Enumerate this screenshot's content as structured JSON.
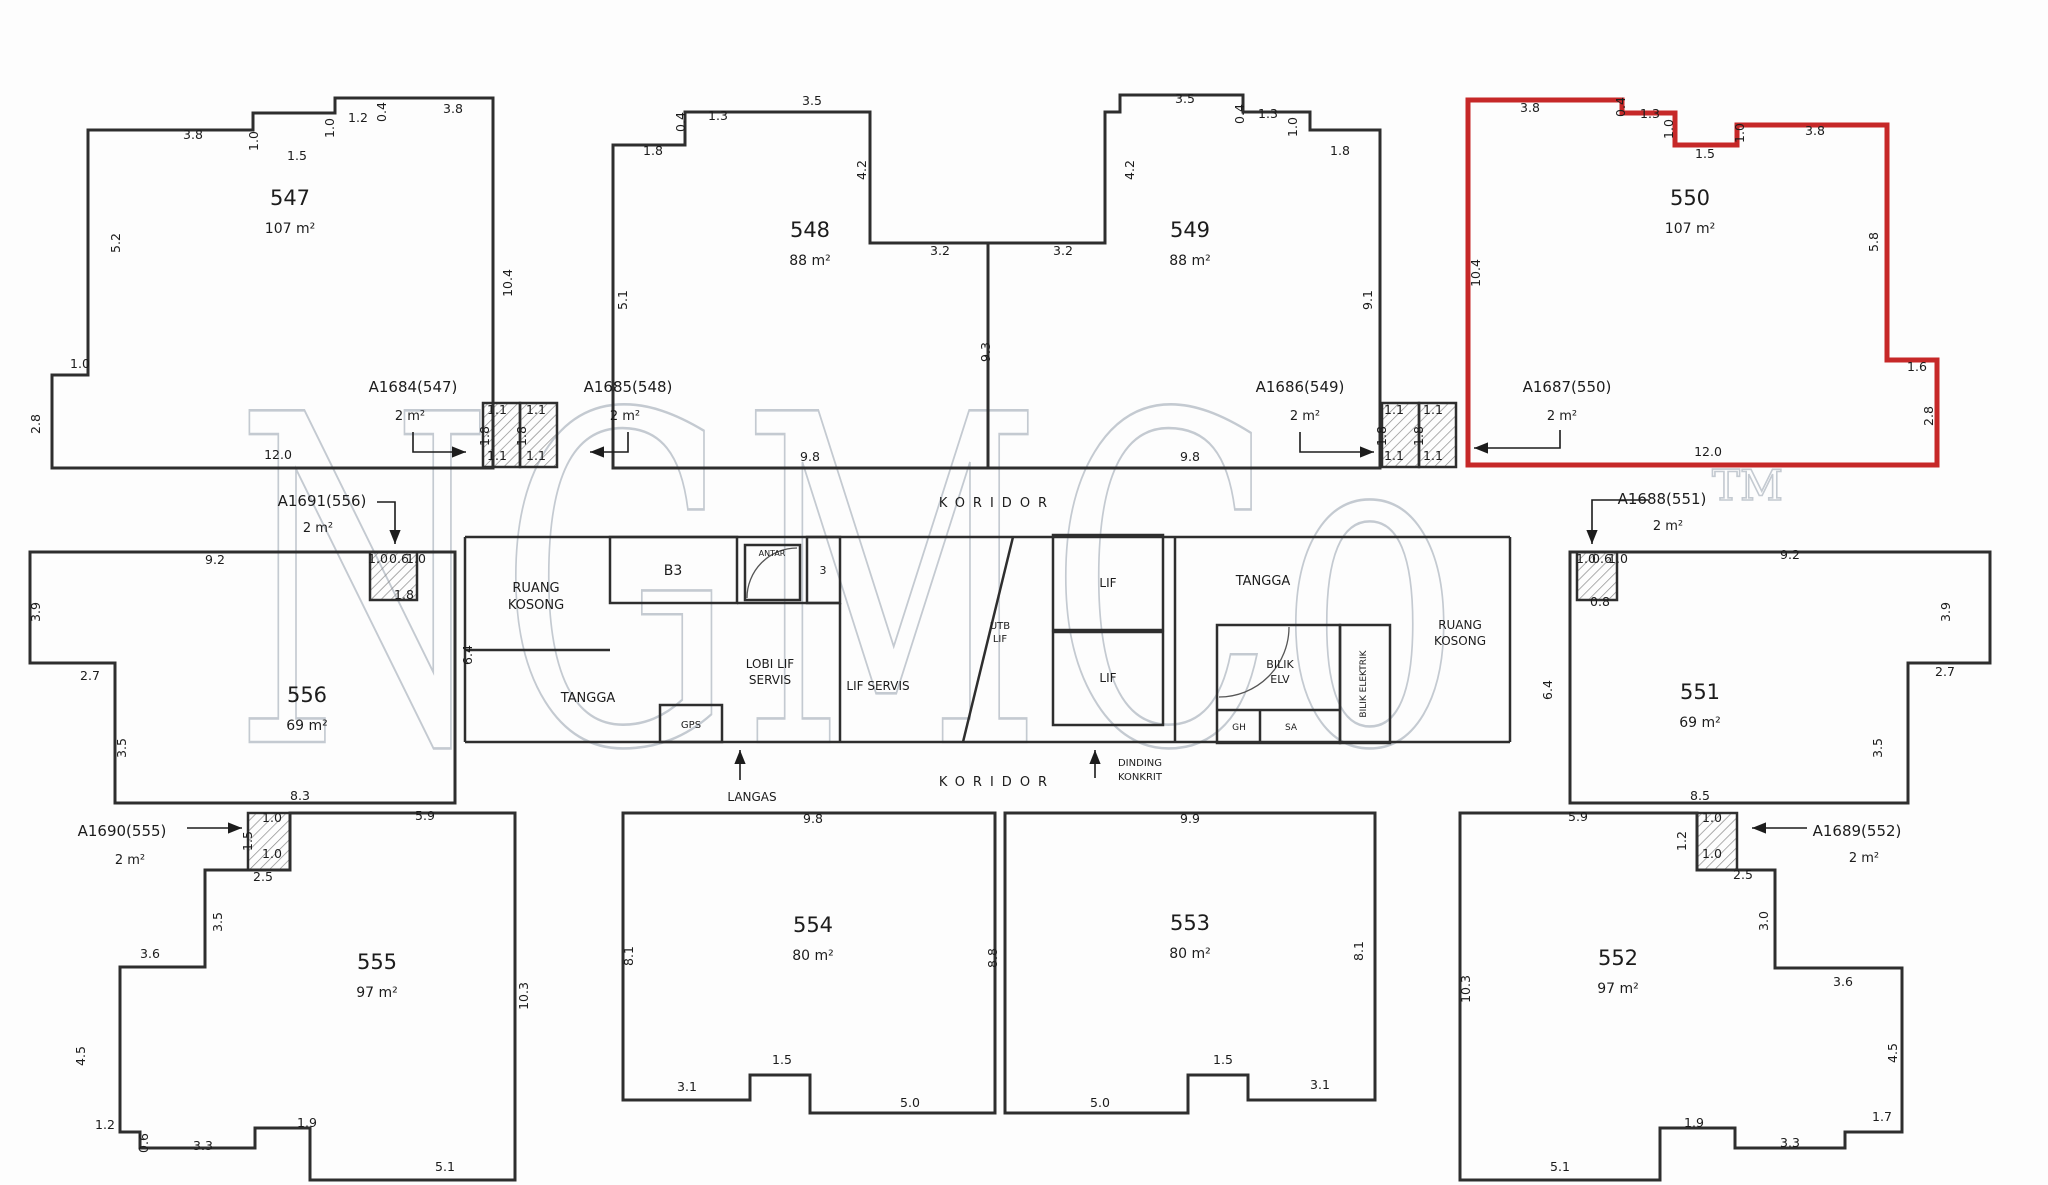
{
  "meta": {
    "background": "#fdfdfd",
    "wall_color": "#2e2e2e",
    "thin_color": "#555555",
    "highlight_color": "#c62828",
    "dim_color": "#1c1c1c",
    "watermark": {
      "text": "NGMCo",
      "tm": "TM",
      "color": "#c4cad1",
      "x": 235,
      "y": 742,
      "size": 455,
      "span": 1230,
      "tm_x": 1712,
      "tm_y": 500,
      "tm_size": 42
    }
  },
  "units": [
    {
      "id": "547",
      "number": "547",
      "area": "107 m²",
      "highlighted": false,
      "points": "88,130 253,130 253,113 335,113 335,98 493,98 493,468 52,468 52,375 88,375",
      "nx": 290,
      "ny": 205,
      "ax": 290,
      "ay": 233
    },
    {
      "id": "548",
      "number": "548",
      "area": "88 m²",
      "highlighted": false,
      "points": "613,145 685,145 685,112 870,112 870,243 988,243 988,468 613,468",
      "nx": 810,
      "ny": 237,
      "ax": 810,
      "ay": 265
    },
    {
      "id": "549",
      "number": "549",
      "area": "88 m²",
      "highlighted": false,
      "points": "1120,95 1243,95 1243,112 1310,112 1310,130 1380,130 1380,468 988,468 988,243 1105,243 1105,112 1120,112",
      "nx": 1190,
      "ny": 237,
      "ax": 1190,
      "ay": 265
    },
    {
      "id": "550",
      "number": "550",
      "area": "107 m²",
      "highlighted": true,
      "points": "1468,100 1622,100 1622,113 1675,113 1675,145 1737,145 1737,125 1887,125 1887,360 1937,360 1937,465 1468,465",
      "nx": 1690,
      "ny": 205,
      "ax": 1690,
      "ay": 233
    },
    {
      "id": "556",
      "number": "556",
      "area": "69 m²",
      "highlighted": false,
      "points": "30,552 455,552 455,803 115,803 115,663 30,663",
      "nx": 307,
      "ny": 702,
      "ax": 307,
      "ay": 730
    },
    {
      "id": "551",
      "number": "551",
      "area": "69 m²",
      "highlighted": false,
      "points": "1570,552 1990,552 1990,663 1908,663 1908,803 1570,803",
      "nx": 1700,
      "ny": 699,
      "ax": 1700,
      "ay": 727
    },
    {
      "id": "555",
      "number": "555",
      "area": "97 m²",
      "highlighted": false,
      "points": "515,813 290,813 290,870 205,870 205,967 120,967 120,1132 140,1132 140,1148 255,1148 255,1128 310,1128 310,1180 515,1180",
      "nx": 377,
      "ny": 969,
      "ax": 377,
      "ay": 997
    },
    {
      "id": "554",
      "number": "554",
      "area": "80 m²",
      "highlighted": false,
      "points": "623,813 995,813 995,1113 810,1113 810,1075 750,1075 750,1100 623,1100",
      "nx": 813,
      "ny": 932,
      "ax": 813,
      "ay": 960
    },
    {
      "id": "553",
      "number": "553",
      "area": "80 m²",
      "highlighted": false,
      "points": "1005,813 1375,813 1375,1100 1248,1100 1248,1075 1188,1075 1188,1113 1005,1113",
      "nx": 1190,
      "ny": 930,
      "ax": 1190,
      "ay": 958
    },
    {
      "id": "552",
      "number": "552",
      "area": "97 m²",
      "highlighted": false,
      "points": "1460,813 1697,813 1697,870 1775,870 1775,968 1902,968 1902,1132 1845,1132 1845,1148 1735,1148 1735,1128 1660,1128 1660,1180 1460,1180",
      "nx": 1618,
      "ny": 965,
      "ax": 1618,
      "ay": 993
    }
  ],
  "ref_labels": [
    {
      "id": "A1684",
      "text": "A1684(547)",
      "sub": "2 m²",
      "x": 413,
      "y": 392,
      "sx": 410,
      "sy": 420,
      "arrow": [
        [
          413,
          432
        ],
        [
          413,
          452
        ],
        [
          466,
          452
        ]
      ],
      "dir": "right"
    },
    {
      "id": "A1685",
      "text": "A1685(548)",
      "sub": "2 m²",
      "x": 628,
      "y": 392,
      "sx": 625,
      "sy": 420,
      "arrow": [
        [
          628,
          432
        ],
        [
          628,
          452
        ],
        [
          590,
          452
        ]
      ],
      "dir": "left"
    },
    {
      "id": "A1686",
      "text": "A1686(549)",
      "sub": "2 m²",
      "x": 1300,
      "y": 392,
      "sx": 1305,
      "sy": 420,
      "arrow": [
        [
          1300,
          432
        ],
        [
          1300,
          452
        ],
        [
          1374,
          452
        ]
      ],
      "dir": "right"
    },
    {
      "id": "A1687",
      "text": "A1687(550)",
      "sub": "2 m²",
      "x": 1567,
      "y": 392,
      "sx": 1562,
      "sy": 420,
      "arrow": [
        [
          1560,
          430
        ],
        [
          1560,
          448
        ],
        [
          1474,
          448
        ]
      ],
      "dir": "left"
    },
    {
      "id": "A1691",
      "text": "A1691(556)",
      "sub": "2 m²",
      "x": 322,
      "y": 506,
      "sx": 318,
      "sy": 532,
      "arrow": [
        [
          377,
          502
        ],
        [
          395,
          502
        ],
        [
          395,
          544
        ]
      ],
      "dir": "down"
    },
    {
      "id": "A1690",
      "text": "A1690(555)",
      "sub": "2 m²",
      "x": 122,
      "y": 836,
      "sx": 130,
      "sy": 864,
      "arrow": [
        [
          187,
          828
        ],
        [
          242,
          828
        ]
      ],
      "dir": "right"
    },
    {
      "id": "A1688",
      "text": "A1688(551)",
      "sub": "2 m²",
      "x": 1662,
      "y": 504,
      "sx": 1668,
      "sy": 530,
      "arrow": [
        [
          1648,
          500
        ],
        [
          1592,
          500
        ],
        [
          1592,
          544
        ]
      ],
      "dir": "down"
    },
    {
      "id": "A1689",
      "text": "A1689(552)",
      "sub": "2 m²",
      "x": 1857,
      "y": 836,
      "sx": 1864,
      "sy": 862,
      "arrow": [
        [
          1807,
          828
        ],
        [
          1752,
          828
        ]
      ],
      "dir": "left"
    }
  ],
  "core_labels": [
    {
      "t": "RUANG",
      "x": 536,
      "y": 592,
      "s": 13
    },
    {
      "t": "KOSONG",
      "x": 536,
      "y": 609,
      "s": 13
    },
    {
      "t": "TANGGA",
      "x": 588,
      "y": 702,
      "s": 13
    },
    {
      "t": "B3",
      "x": 673,
      "y": 575,
      "s": 14
    },
    {
      "t": "ANTAR",
      "x": 772,
      "y": 556,
      "s": 8
    },
    {
      "t": "3",
      "x": 823,
      "y": 574,
      "s": 11
    },
    {
      "t": "LOBI LIF",
      "x": 770,
      "y": 668,
      "s": 12
    },
    {
      "t": "SERVIS",
      "x": 770,
      "y": 684,
      "s": 12
    },
    {
      "t": "LIF SERVIS",
      "x": 878,
      "y": 690,
      "s": 12
    },
    {
      "t": "GPS",
      "x": 691,
      "y": 728,
      "s": 10
    },
    {
      "t": "LANGAS",
      "x": 752,
      "y": 801,
      "s": 12
    },
    {
      "t": "LIF",
      "x": 1108,
      "y": 587,
      "s": 12
    },
    {
      "t": "LIF",
      "x": 1108,
      "y": 682,
      "s": 12
    },
    {
      "t": "UTB",
      "x": 1000,
      "y": 629,
      "s": 10
    },
    {
      "t": "LIF",
      "x": 1000,
      "y": 642,
      "s": 10
    },
    {
      "t": "TANGGA",
      "x": 1263,
      "y": 585,
      "s": 13
    },
    {
      "t": "BILIK",
      "x": 1280,
      "y": 668,
      "s": 11
    },
    {
      "t": "ELV",
      "x": 1280,
      "y": 683,
      "s": 11
    },
    {
      "t": "GH",
      "x": 1239,
      "y": 730,
      "s": 9
    },
    {
      "t": "SA",
      "x": 1291,
      "y": 730,
      "s": 9
    },
    {
      "t": "BILIK ELEKTRIK",
      "x": 1366,
      "y": 684,
      "s": 9,
      "r": 1
    },
    {
      "t": "RUANG",
      "x": 1460,
      "y": 629,
      "s": 12
    },
    {
      "t": "KOSONG",
      "x": 1460,
      "y": 645,
      "s": 12
    },
    {
      "t": "DINDING",
      "x": 1140,
      "y": 766,
      "s": 10
    },
    {
      "t": "KONKRIT",
      "x": 1140,
      "y": 780,
      "s": 10
    },
    {
      "t": "KORIDOR",
      "x": 997,
      "y": 507,
      "s": 13,
      "ls": 8
    },
    {
      "t": "KORIDOR",
      "x": 997,
      "y": 786,
      "s": 13,
      "ls": 8
    }
  ],
  "plain_arrows": [
    {
      "id": "langas-arrow",
      "pts": [
        [
          740,
          780
        ],
        [
          740,
          750
        ]
      ],
      "dir": "up"
    },
    {
      "id": "dinding-konkrit-arrow",
      "pts": [
        [
          1095,
          778
        ],
        [
          1095,
          750
        ]
      ],
      "dir": "up"
    }
  ],
  "dims": [
    [
      "3.8",
      193,
      139
    ],
    [
      "1.0",
      258,
      141,
      1
    ],
    [
      "1.5",
      297,
      160
    ],
    [
      "1.0",
      334,
      128,
      1
    ],
    [
      "1.2",
      358,
      122
    ],
    [
      "0.4",
      386,
      112,
      1
    ],
    [
      "3.8",
      453,
      113
    ],
    [
      "5.2",
      120,
      243,
      1
    ],
    [
      "10.4",
      512,
      283,
      1
    ],
    [
      "1.0",
      80,
      368
    ],
    [
      "2.8",
      40,
      424,
      1
    ],
    [
      "12.0",
      278,
      459
    ],
    [
      "1.8",
      653,
      155
    ],
    [
      "0.4",
      685,
      122,
      1
    ],
    [
      "1.3",
      718,
      120
    ],
    [
      "3.5",
      812,
      105
    ],
    [
      "4.2",
      866,
      170,
      1
    ],
    [
      "5.1",
      627,
      300,
      1
    ],
    [
      "3.2",
      940,
      255
    ],
    [
      "3.2",
      1063,
      255
    ],
    [
      "9.3",
      990,
      352,
      1
    ],
    [
      "9.8",
      810,
      461
    ],
    [
      "3.5",
      1185,
      103
    ],
    [
      "0.4",
      1244,
      114,
      1
    ],
    [
      "1.3",
      1268,
      118
    ],
    [
      "1.0",
      1297,
      127,
      1
    ],
    [
      "1.8",
      1340,
      155
    ],
    [
      "4.2",
      1134,
      170,
      1
    ],
    [
      "9.1",
      1372,
      300,
      1
    ],
    [
      "9.8",
      1190,
      461
    ],
    [
      "3.8",
      1530,
      112
    ],
    [
      "0.4",
      1625,
      107,
      1
    ],
    [
      "1.3",
      1650,
      118
    ],
    [
      "1.0",
      1673,
      129,
      1
    ],
    [
      "1.5",
      1705,
      158
    ],
    [
      "1.0",
      1744,
      133,
      1
    ],
    [
      "3.8",
      1815,
      135
    ],
    [
      "10.4",
      1480,
      273,
      1
    ],
    [
      "5.8",
      1878,
      242,
      1
    ],
    [
      "1.6",
      1917,
      371
    ],
    [
      "2.8",
      1933,
      416,
      1
    ],
    [
      "12.0",
      1708,
      456
    ],
    [
      "1.1",
      497,
      414
    ],
    [
      "1.1",
      536,
      414
    ],
    [
      "1.1",
      497,
      460
    ],
    [
      "1.1",
      536,
      460
    ],
    [
      "1.8",
      489,
      436,
      1
    ],
    [
      "1.8",
      526,
      436,
      1
    ],
    [
      "1.1",
      1394,
      414
    ],
    [
      "1.1",
      1433,
      414
    ],
    [
      "1.1",
      1394,
      460
    ],
    [
      "1.1",
      1433,
      460
    ],
    [
      "1.8",
      1386,
      436,
      1
    ],
    [
      "1.8",
      1423,
      436,
      1
    ],
    [
      "9.2",
      215,
      564
    ],
    [
      "3.9",
      40,
      612,
      1
    ],
    [
      "2.7",
      90,
      680
    ],
    [
      "3.5",
      126,
      748,
      1
    ],
    [
      "6.4",
      472,
      655,
      1
    ],
    [
      "8.3",
      300,
      800
    ],
    [
      "1.0",
      378,
      563
    ],
    [
      "0.6",
      399,
      563
    ],
    [
      "1.0",
      416,
      563
    ],
    [
      "1.8",
      404,
      599
    ],
    [
      "9.2",
      1790,
      559
    ],
    [
      "3.9",
      1950,
      612,
      1
    ],
    [
      "2.7",
      1945,
      676
    ],
    [
      "3.5",
      1882,
      748,
      1
    ],
    [
      "6.4",
      1552,
      690,
      1
    ],
    [
      "8.5",
      1700,
      800
    ],
    [
      "1.0",
      1586,
      563
    ],
    [
      "0.6",
      1602,
      563
    ],
    [
      "1.0",
      1618,
      563
    ],
    [
      "0.8",
      1600,
      606
    ],
    [
      "5.9",
      425,
      820
    ],
    [
      "1.0",
      272,
      822
    ],
    [
      "1.5",
      252,
      841,
      1
    ],
    [
      "1.0",
      272,
      858
    ],
    [
      "2.5",
      263,
      881
    ],
    [
      "3.5",
      222,
      922,
      1
    ],
    [
      "3.6",
      150,
      958
    ],
    [
      "4.5",
      85,
      1056,
      1
    ],
    [
      "1.2",
      105,
      1129
    ],
    [
      "0.6",
      148,
      1143,
      1
    ],
    [
      "3.3",
      203,
      1150
    ],
    [
      "1.9",
      307,
      1127
    ],
    [
      "5.1",
      445,
      1171
    ],
    [
      "10.3",
      528,
      996,
      1
    ],
    [
      "9.8",
      813,
      823
    ],
    [
      "8.1",
      633,
      956,
      1
    ],
    [
      "3.1",
      687,
      1091
    ],
    [
      "1.5",
      782,
      1064
    ],
    [
      "5.0",
      910,
      1107
    ],
    [
      "9.9",
      1190,
      823
    ],
    [
      "8.8",
      997,
      958,
      1
    ],
    [
      "8.1",
      1363,
      951,
      1
    ],
    [
      "1.5",
      1223,
      1064
    ],
    [
      "3.1",
      1320,
      1089
    ],
    [
      "5.0",
      1100,
      1107
    ],
    [
      "5.9",
      1578,
      821
    ],
    [
      "1.0",
      1712,
      822
    ],
    [
      "1.2",
      1686,
      841,
      1
    ],
    [
      "1.0",
      1712,
      858
    ],
    [
      "2.5",
      1743,
      879
    ],
    [
      "3.0",
      1768,
      921,
      1
    ],
    [
      "3.6",
      1843,
      986
    ],
    [
      "4.5",
      1897,
      1053,
      1
    ],
    [
      "1.7",
      1882,
      1121
    ],
    [
      "3.3",
      1790,
      1147
    ],
    [
      "1.9",
      1694,
      1127
    ],
    [
      "5.1",
      1560,
      1171
    ],
    [
      "10.3",
      1470,
      989,
      1
    ]
  ],
  "core_rects": [
    {
      "n": "room-b3",
      "x": 610,
      "y": 537,
      "w": 127,
      "h": 66
    },
    {
      "n": "room-antar",
      "x": 745,
      "y": 545,
      "w": 55,
      "h": 55
    },
    {
      "n": "room-3",
      "x": 807,
      "y": 537,
      "w": 33,
      "h": 66
    },
    {
      "n": "lift-shaft-1",
      "x": 1053,
      "y": 535,
      "w": 110,
      "h": 95
    },
    {
      "n": "lift-shaft-2",
      "x": 1053,
      "y": 632,
      "w": 110,
      "h": 93
    },
    {
      "n": "room-bilik-elv",
      "x": 1217,
      "y": 625,
      "w": 123,
      "h": 118
    },
    {
      "n": "room-bilik-elektrik",
      "x": 1340,
      "y": 625,
      "w": 50,
      "h": 118
    },
    {
      "n": "room-gps",
      "x": 660,
      "y": 705,
      "w": 62,
      "h": 37
    }
  ],
  "duct_shafts": [
    [
      483,
      403,
      37,
      64
    ],
    [
      520,
      403,
      37,
      64
    ],
    [
      1382,
      403,
      37,
      64
    ],
    [
      1419,
      403,
      37,
      64
    ],
    [
      370,
      552,
      47,
      48
    ],
    [
      1577,
      552,
      40,
      48
    ],
    [
      248,
      813,
      42,
      57
    ],
    [
      1697,
      813,
      40,
      57
    ]
  ],
  "lines": [
    [
      465,
      537,
      1510,
      537
    ],
    [
      465,
      537,
      465,
      742
    ],
    [
      1510,
      537,
      1510,
      742
    ],
    [
      465,
      742,
      1510,
      742
    ],
    [
      465,
      650,
      610,
      650
    ],
    [
      737,
      603,
      840,
      603
    ],
    [
      840,
      603,
      840,
      742
    ],
    [
      1013,
      537,
      963,
      742
    ],
    [
      1175,
      537,
      1175,
      742
    ],
    [
      1217,
      710,
      1340,
      710
    ],
    [
      1260,
      710,
      1260,
      743
    ]
  ],
  "arcs": [
    "M 1219 697 A 70 70 0 0 0 1289 627",
    "M 747 598 A 50 50 0 0 1 797 548"
  ]
}
